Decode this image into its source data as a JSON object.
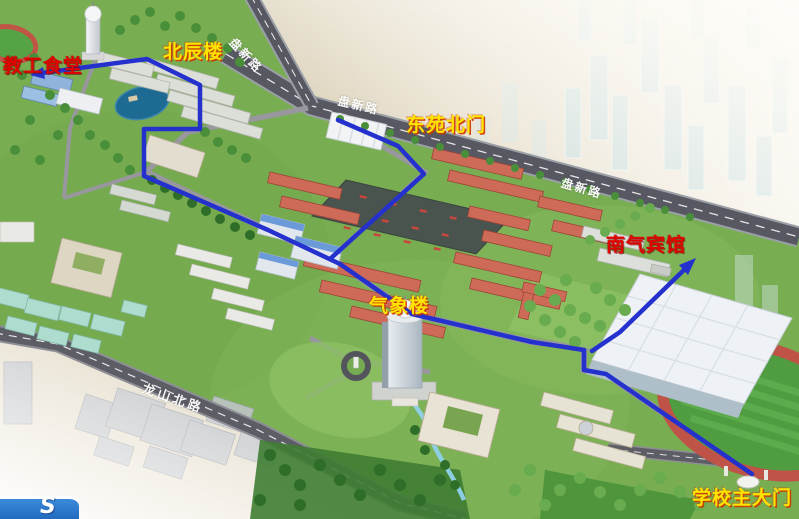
{
  "map_type": "campus-3d-aerial-map",
  "route_color": "#2531cd",
  "labels": [
    {
      "id": "faculty-dining-hall",
      "text": "教工食堂",
      "color": "#e00300"
    },
    {
      "id": "beichen-building",
      "text": "北辰楼",
      "color": "#ffe400"
    },
    {
      "id": "east-yard-north-gate",
      "text": "东苑北门",
      "color": "#ffe400"
    },
    {
      "id": "meteorology-building",
      "text": "气象楼",
      "color": "#ffe400"
    },
    {
      "id": "nanqi-hotel",
      "text": "南气宾馆",
      "color": "#d40000"
    },
    {
      "id": "school-main-gate",
      "text": "学校主大门",
      "color": "#ffd800"
    }
  ],
  "road_labels": [
    {
      "id": "panxin-road-branch",
      "text": "盘新路"
    },
    {
      "id": "panxin-road-main",
      "text": "盘新路"
    },
    {
      "id": "panxin-road-east",
      "text": "盘新路"
    },
    {
      "id": "longshan-north-road",
      "text": "龙山北路"
    }
  ],
  "logo": {
    "glyph": "S",
    "color": "#2779cc"
  }
}
